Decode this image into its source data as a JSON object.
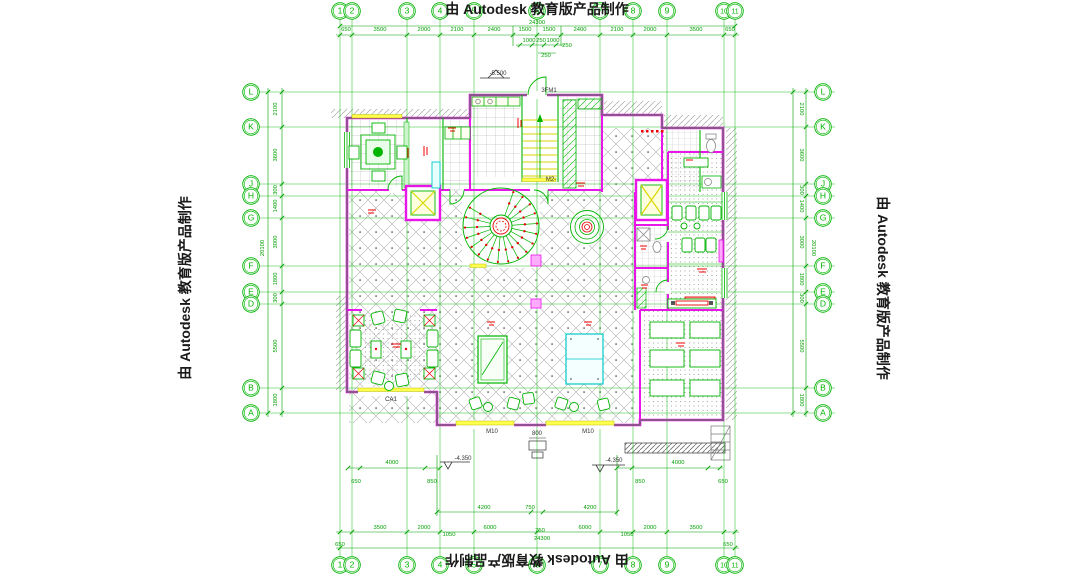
{
  "watermark": {
    "text": "由 Autodesk 教育版产品制作"
  },
  "grid": {
    "columns": [
      {
        "label": "1",
        "x": 340
      },
      {
        "label": "2",
        "x": 352
      },
      {
        "label": "3",
        "x": 407
      },
      {
        "label": "4",
        "x": 440
      },
      {
        "label": "5",
        "x": 474
      },
      {
        "label": "6",
        "x": 537
      },
      {
        "label": "7",
        "x": 600
      },
      {
        "label": "8",
        "x": 633
      },
      {
        "label": "9",
        "x": 667
      },
      {
        "label": "10",
        "x": 724
      },
      {
        "label": "11",
        "x": 735
      }
    ],
    "rows": [
      {
        "label": "L",
        "y": 92
      },
      {
        "label": "K",
        "y": 127
      },
      {
        "label": "J",
        "y": 184
      },
      {
        "label": "H",
        "y": 196
      },
      {
        "label": "G",
        "y": 218
      },
      {
        "label": "F",
        "y": 266
      },
      {
        "label": "E",
        "y": 292
      },
      {
        "label": "D",
        "y": 304
      },
      {
        "label": "B",
        "y": 388
      },
      {
        "label": "A",
        "y": 413
      }
    ],
    "top_bubble_y": 11,
    "bottom_bubble_y": 565,
    "left_bubble_x": 251,
    "right_bubble_x": 823
  },
  "dims": {
    "top": [
      {
        "t": "24300",
        "x": 537,
        "y": 24
      },
      {
        "t": "650",
        "x": 346,
        "y": 31
      },
      {
        "t": "3500",
        "x": 380,
        "y": 31
      },
      {
        "t": "2000",
        "x": 424,
        "y": 31
      },
      {
        "t": "2100",
        "x": 457,
        "y": 31
      },
      {
        "t": "2400",
        "x": 494,
        "y": 31
      },
      {
        "t": "1500",
        "x": 525,
        "y": 31
      },
      {
        "t": "1500",
        "x": 549,
        "y": 31
      },
      {
        "t": "2400",
        "x": 580,
        "y": 31
      },
      {
        "t": "2100",
        "x": 617,
        "y": 31
      },
      {
        "t": "2000",
        "x": 650,
        "y": 31
      },
      {
        "t": "3500",
        "x": 696,
        "y": 31
      },
      {
        "t": "650",
        "x": 730,
        "y": 31
      },
      {
        "t": "1000",
        "x": 529,
        "y": 42
      },
      {
        "t": "250",
        "x": 541,
        "y": 42
      },
      {
        "t": "1000",
        "x": 553,
        "y": 42
      },
      {
        "t": "250",
        "x": 567,
        "y": 47
      },
      {
        "t": "250",
        "x": 546,
        "y": 57
      }
    ],
    "bottom": [
      {
        "t": "4000",
        "x": 392,
        "y": 464
      },
      {
        "t": "4000",
        "x": 678,
        "y": 464
      },
      {
        "t": "650",
        "x": 356,
        "y": 483
      },
      {
        "t": "850",
        "x": 432,
        "y": 483
      },
      {
        "t": "850",
        "x": 640,
        "y": 483
      },
      {
        "t": "650",
        "x": 723,
        "y": 483
      },
      {
        "t": "4200",
        "x": 484,
        "y": 509
      },
      {
        "t": "750",
        "x": 530,
        "y": 509
      },
      {
        "t": "4200",
        "x": 590,
        "y": 509
      },
      {
        "t": "3500",
        "x": 380,
        "y": 529
      },
      {
        "t": "2000",
        "x": 424,
        "y": 529
      },
      {
        "t": "1050",
        "x": 449,
        "y": 536
      },
      {
        "t": "6000",
        "x": 490,
        "y": 529
      },
      {
        "t": "750",
        "x": 540,
        "y": 532
      },
      {
        "t": "6000",
        "x": 585,
        "y": 529
      },
      {
        "t": "1050",
        "x": 627,
        "y": 536
      },
      {
        "t": "2000",
        "x": 650,
        "y": 529
      },
      {
        "t": "3500",
        "x": 696,
        "y": 529
      },
      {
        "t": "650",
        "x": 340,
        "y": 546
      },
      {
        "t": "24300",
        "x": 542,
        "y": 540
      },
      {
        "t": "650",
        "x": 728,
        "y": 546
      }
    ],
    "left": [
      {
        "t": "2100",
        "x": 277,
        "y": 109
      },
      {
        "t": "3600",
        "x": 277,
        "y": 155
      },
      {
        "t": "300",
        "x": 277,
        "y": 190
      },
      {
        "t": "1400",
        "x": 277,
        "y": 206
      },
      {
        "t": "3000",
        "x": 277,
        "y": 242
      },
      {
        "t": "20100",
        "x": 264,
        "y": 248
      },
      {
        "t": "1800",
        "x": 277,
        "y": 279
      },
      {
        "t": "300",
        "x": 277,
        "y": 298
      },
      {
        "t": "5500",
        "x": 277,
        "y": 346
      },
      {
        "t": "1800",
        "x": 277,
        "y": 400
      }
    ],
    "right": [
      {
        "t": "2100",
        "x": 800,
        "y": 109
      },
      {
        "t": "3600",
        "x": 800,
        "y": 155
      },
      {
        "t": "300",
        "x": 800,
        "y": 190
      },
      {
        "t": "1400",
        "x": 800,
        "y": 206
      },
      {
        "t": "3000",
        "x": 800,
        "y": 242
      },
      {
        "t": "20100",
        "x": 812,
        "y": 248
      },
      {
        "t": "1800",
        "x": 800,
        "y": 279
      },
      {
        "t": "300",
        "x": 800,
        "y": 298
      },
      {
        "t": "5500",
        "x": 800,
        "y": 346
      },
      {
        "t": "1800",
        "x": 800,
        "y": 400
      }
    ]
  },
  "plan_labels": [
    {
      "t": "-5.500",
      "x": 498,
      "y": 75
    },
    {
      "t": "3FM1",
      "x": 549,
      "y": 92
    },
    {
      "t": "M2-",
      "x": 551,
      "y": 181
    },
    {
      "t": "CA1",
      "x": 391,
      "y": 401
    },
    {
      "t": "M10",
      "x": 492,
      "y": 433
    },
    {
      "t": "M10",
      "x": 588,
      "y": 433
    },
    {
      "t": "800",
      "x": 537,
      "y": 435
    },
    {
      "t": "-4.350",
      "x": 463,
      "y": 460
    },
    {
      "t": "-4.350",
      "x": 614,
      "y": 462
    }
  ],
  "colors": {
    "cad_green": "#00b400",
    "magenta": "#e816e8",
    "yellow": "#f2f200",
    "cyan": "#00c8c8",
    "red": "#e80000",
    "tile_gray": "#bdbdbd",
    "watermark_text": "#1a1a1a",
    "dim_green": "#00a000"
  }
}
